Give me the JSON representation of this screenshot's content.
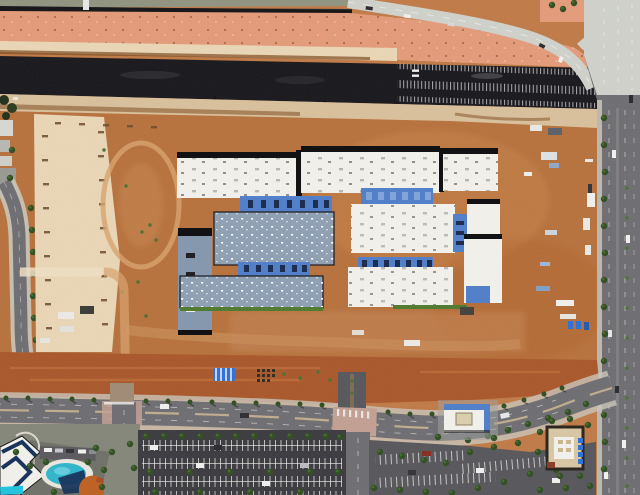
{
  "meta": {
    "title": "Aerial photograph — desert construction site of a large campus with surrounding roads",
    "type": "oblique-aerial-photo",
    "width_px": 640,
    "height_px": 495
  },
  "scene": {
    "description": "Top-down aerial photo of a school/campus construction project on orange desert dirt. A freshly paved dark freeway corridor crosses the top, with a light concrete on-ramp curving to a multi-lane arterial road on the right edge. Center: white-roofed buildings with black shadow edges and blue clerestory strips plus two gray-blue roofed halls. Left: pale graded pad with survey stake rows and a dirt loop track. Bottom: landscaped boulevard with palm trees, a signalized intersection, large parking lots, a hotel with swimming pool (bottom-left), a white/blue retail building and a tan restaurant pad (bottom-right).",
    "features": [
      "freeway-corridor",
      "onramp-road",
      "arterial-road-right",
      "frontage-road-top",
      "graded-pad-left",
      "dirt-loop-track",
      "campus-buildings-white",
      "campus-halls-grayblue",
      "blue-clerestory-strips",
      "construction-materials",
      "site-trailers",
      "striped-canopy",
      "boulevard-road-bottom",
      "main-intersection",
      "hotel-with-pool",
      "large-parking-lot",
      "retail-parking-lot",
      "retail-building",
      "restaurant-building",
      "street-trees",
      "palm-trees"
    ],
    "building_counts": {
      "white_roof_buildings": 7,
      "grayblue_roof_halls": 3,
      "blue_clerestory_strips": 4
    },
    "vehicle_notes": "a few cars on ramp, arterial road, boulevard and parking rows"
  },
  "palette": {
    "dirt-orange": "#c07a46",
    "dirt-orange-deep": "#ad6530",
    "dirt-red": "#a9572a",
    "dirt-salmon": "#e49b79",
    "dirt-cream": "#ead6b6",
    "dirt-tan": "#d9c09c",
    "track-light": "#d8a26c",
    "freeway-asphalt": "#17171c",
    "old-road-asphalt": "#131316",
    "concrete": "#cfd1ca",
    "road-gray": "#6e6e72",
    "road-gray-dark": "#57575b",
    "parking-dark": "#3a3a3f",
    "parking-mid": "#56565b",
    "sidewalk": "#c9c6ba",
    "paver-pink": "#c2a093",
    "line-white": "#f4f4f1",
    "roof-white": "#f3f1ec",
    "shadow-black": "#0c0c0e",
    "roof-blue": "#4f7ec9",
    "roof-blue-light": "#7fa4dc",
    "window-navy": "#18294d",
    "roof-grayblue": "#8fa0b4",
    "roof-grayblue-2": "#8497ad",
    "green-tree": "#2f4d20",
    "green-tree-light": "#4a7030",
    "green-strip": "#4e7a2d",
    "pool-teal": "#2fb5cb",
    "pool-cyan": "#1fc4de",
    "navy-shade": "#143059",
    "canopy-orange": "#bf6022",
    "bldg-tan": "#d8c7a4",
    "trim-dark": "#29221a",
    "steel-blue": "#2f6fd8",
    "brown-streak": "#7c4a1f"
  }
}
